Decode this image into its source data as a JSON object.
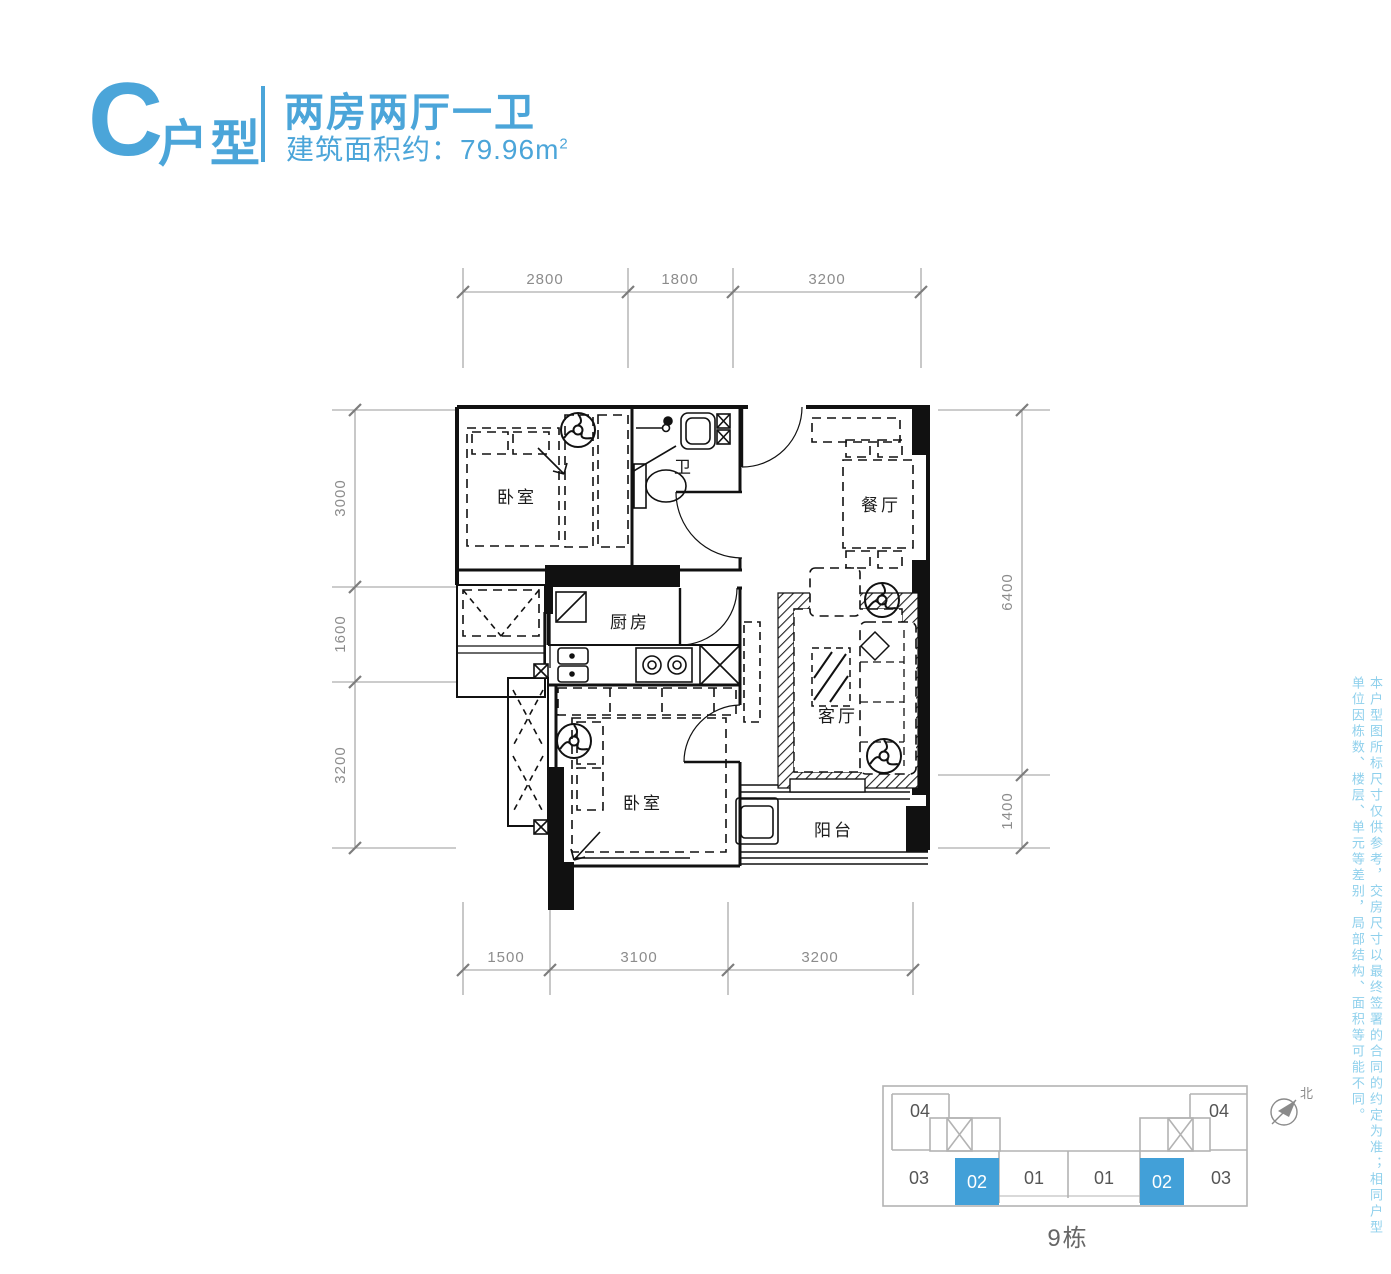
{
  "header": {
    "type_letter": "C",
    "type_suffix": "户型",
    "title": "两房两厅一卫",
    "area_text": "建筑面积约：79.96m",
    "area_sup": "2"
  },
  "colors": {
    "accent_blue": "#4ba5d9",
    "keyplan_highlight": "#42a0d8",
    "plan_line": "#1a1a1a",
    "dim_gray": "#8c8c8c",
    "disclaimer_blue": "#8fd0ec"
  },
  "plan": {
    "rooms": {
      "bedroom1": "卧室",
      "bath": "卫",
      "dining": "餐厅",
      "kitchen": "厨房",
      "living": "客厅",
      "bedroom2": "卧室",
      "balcony": "阳台"
    },
    "dims": {
      "top": [
        "2800",
        "1800",
        "3200"
      ],
      "bottom": [
        "1500",
        "3100",
        "3200"
      ],
      "left": [
        "3000",
        "1600",
        "3200"
      ],
      "right": [
        "6400",
        "1400"
      ]
    }
  },
  "keyplan": {
    "units": [
      "04",
      "03",
      "02",
      "01",
      "01",
      "02",
      "03",
      "04"
    ],
    "building": "9栋",
    "north": "北"
  },
  "disclaimer": "本户型图所标尺寸仅供参考，交房尺寸以最终签署的合同的约定为准；相同户型单位因栋数、楼层、单元等差别，局部结构、面积等可能不同。"
}
